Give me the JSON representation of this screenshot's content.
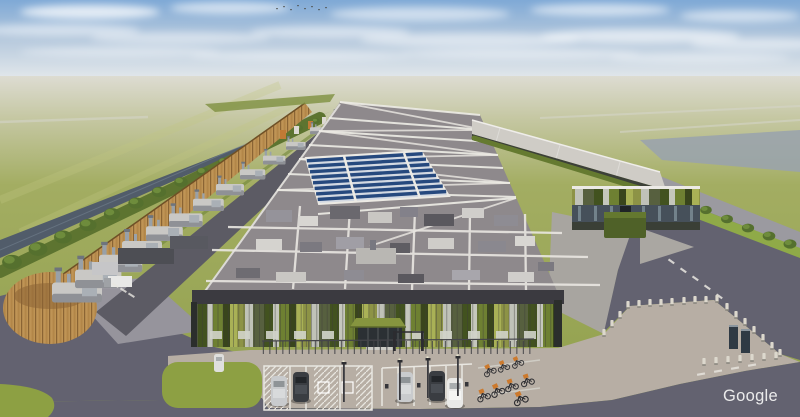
{
  "scene": {
    "watermark": "Google",
    "description": "3D aerial rendering of a hyperscale data center campus in flat green farmland",
    "elements": {
      "main_hall": "long data hall with rooftop plant, white walkway markings and diagonal bay stripes",
      "solar_array": "rows of rooftop solar panels",
      "generator_row": "backup generator units behind a timber acoustic fence",
      "timber_drum": "circular timber-screen enclosure",
      "canal": "drainage canal with tree line",
      "facade": "vertical green and grey cladding panels with entrance canopy",
      "gatehouse": "green-clad entrance building with glass band",
      "parking": "car park with marked stalls, hatched zones, EV marks, light poles and cargo-bike racks",
      "perimeter": "concrete bollards, security fence and access roads"
    }
  },
  "palette": {
    "sky_top": "#7fa9d6",
    "sky_horizon": "#e6eaec",
    "field_green": "#a3ad62",
    "water": "#515c6a",
    "pond": "#99a2ae",
    "tree": "#55702e",
    "wood": "#bf9455",
    "roof": "#8e898c",
    "roof_light": "#cfccc6",
    "walkway": "#eceae4",
    "solar_blue": "#26497e",
    "solar_base": "#d3d9e2",
    "equipment_light": "#c9c8c5",
    "equipment_dark": "#5e5c62",
    "facade_green": "#6e8032",
    "facade_dark_green": "#42521f",
    "facade_base": "#b9bdb0",
    "canopy_green": "#86953f",
    "glass": "#2b3034",
    "road": "#636270",
    "road_light": "#96949c",
    "plaza": "#b7aea4",
    "grass": "#8da043",
    "bollard": "#dcd8cd",
    "car_dark": "#3a3d42",
    "car_silver": "#c9cbcd",
    "car_white": "#e9e9e7",
    "bike_orange": "#cc7a2e",
    "watermark": "#f2f2f2"
  }
}
